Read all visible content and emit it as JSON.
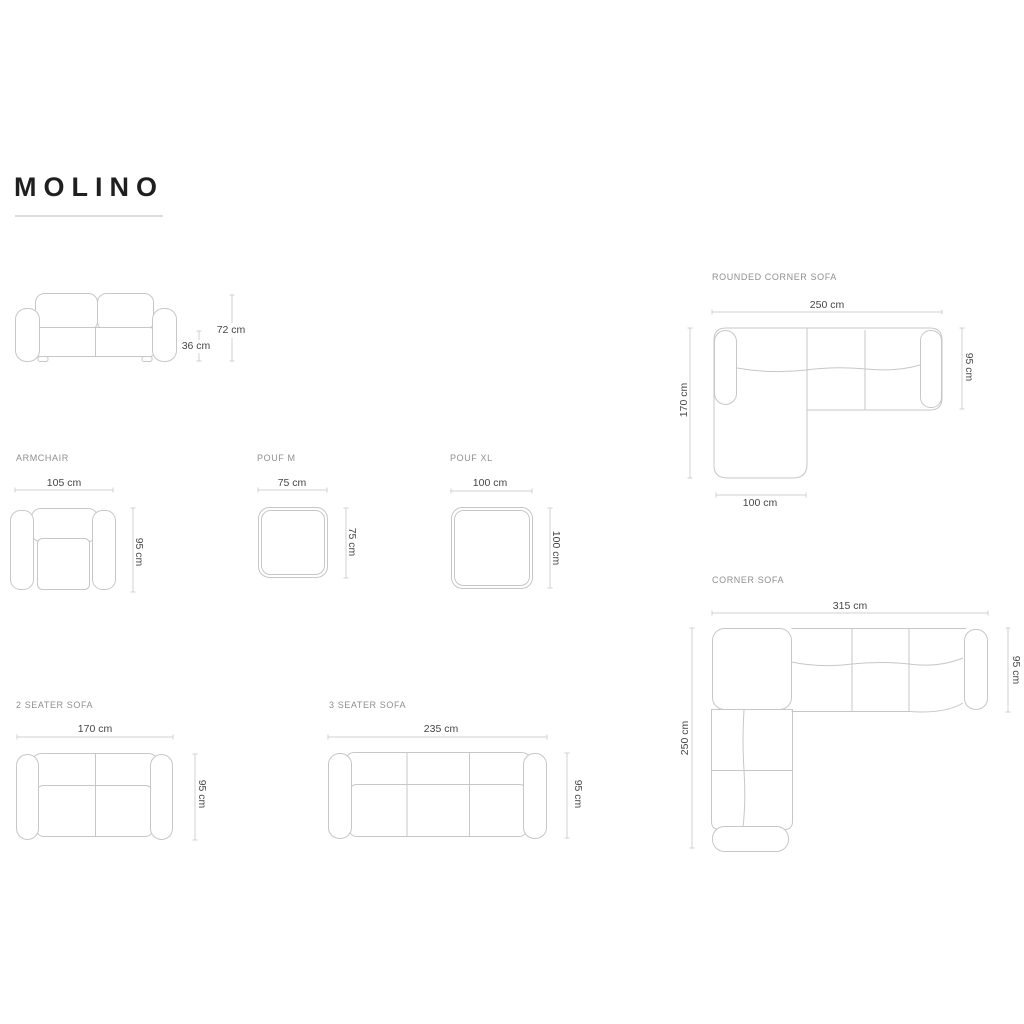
{
  "page": {
    "title": "MOLINO"
  },
  "colors": {
    "background": "#ffffff",
    "title_text": "#1f1f1f",
    "section_label_text": "#8f8f8f",
    "dimension_text": "#464646",
    "line_art": "#c7c7c7",
    "dimension_line": "#d0d0d0",
    "title_underline": "#dcdcdc"
  },
  "sections": {
    "sofa_front_view": {
      "height": "72 cm",
      "seat_height": "36 ccm"
    },
    "armchair": {
      "label": "ARMCHAIR",
      "width": "105 cm",
      "depth": "95 cm"
    },
    "pouf_m": {
      "label": "POUF M",
      "width": "75 cm",
      "depth": "75 cm"
    },
    "pouf_xl": {
      "label": "POUF XL",
      "width": "100 cm",
      "depth": "100 cm"
    },
    "rounded_corner_sofa": {
      "label": "ROUNDED CORNER SOFA",
      "width": "250 cm",
      "total_depth": "170 cm",
      "depth": "95 cm",
      "chaise_width": "100 cm"
    },
    "corner_sofa": {
      "label": "CORNER SOFA",
      "width": "315 cm",
      "total_depth": "250 cm",
      "depth": "95 cm"
    },
    "two_seater": {
      "label": "2 SEATER SOFA",
      "width": "170 cm",
      "depth": "95 cm"
    },
    "three_seater": {
      "label": "3 SEATER SOFA",
      "width": "235 cm",
      "depth": "95 cm"
    }
  }
}
